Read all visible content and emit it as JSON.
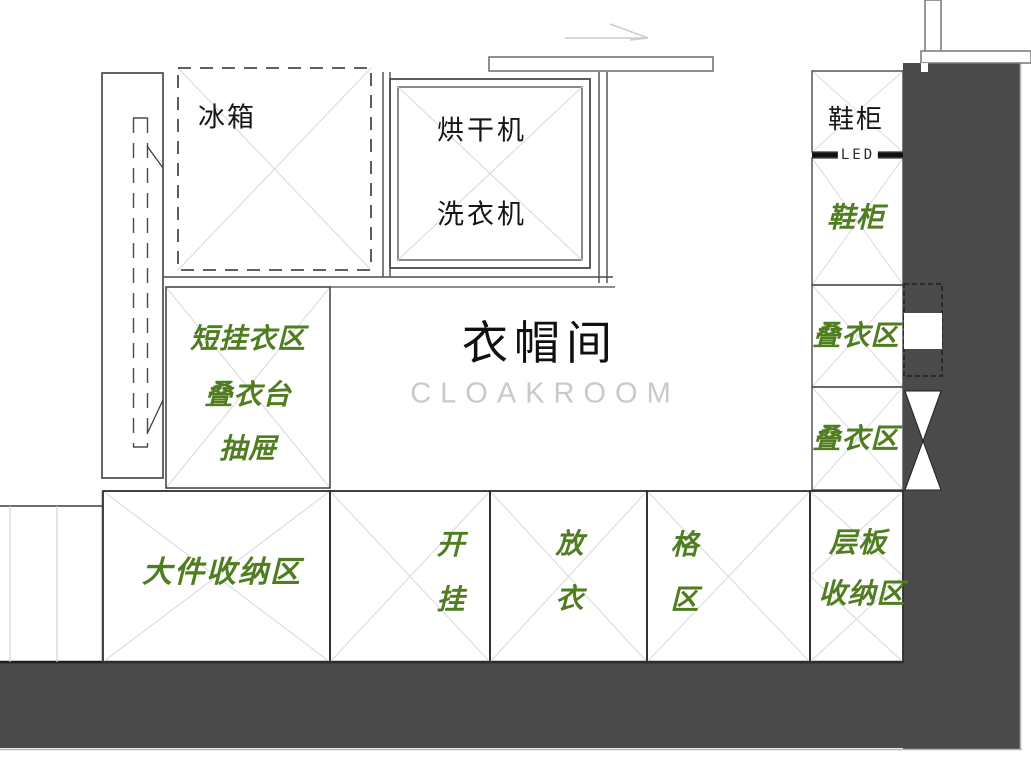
{
  "colors": {
    "zone_label_green": "#4f7d1f",
    "wall_fill": "#4a4a4a",
    "cross_line_gray": "#dedede",
    "cloakroom_text_gray": "#c9c9c9"
  },
  "room": {
    "title_cn": "衣帽间",
    "title_en": "CLOAKROOM"
  },
  "appliances": {
    "fridge": "冰箱",
    "dryer": "烘干机",
    "washer": "洗衣机"
  },
  "shoe_cabinet": {
    "top_label": "鞋柜",
    "led_label": "LED",
    "green_label": "鞋柜"
  },
  "right_column": {
    "fold_zone_1": "叠衣区",
    "fold_zone_2": "叠衣区"
  },
  "wardrobe_left": {
    "line1": "短挂衣区",
    "line2": "叠衣台",
    "line3": "抽屉"
  },
  "bottom_row": {
    "bulk_storage": "大件收纳区",
    "hanging_1": "开",
    "hanging_2": "挂",
    "clothes_1": "放",
    "clothes_2": "衣",
    "grid_1": "格",
    "grid_2": "区",
    "shelf_1": "层板",
    "shelf_2": "收纳区"
  }
}
